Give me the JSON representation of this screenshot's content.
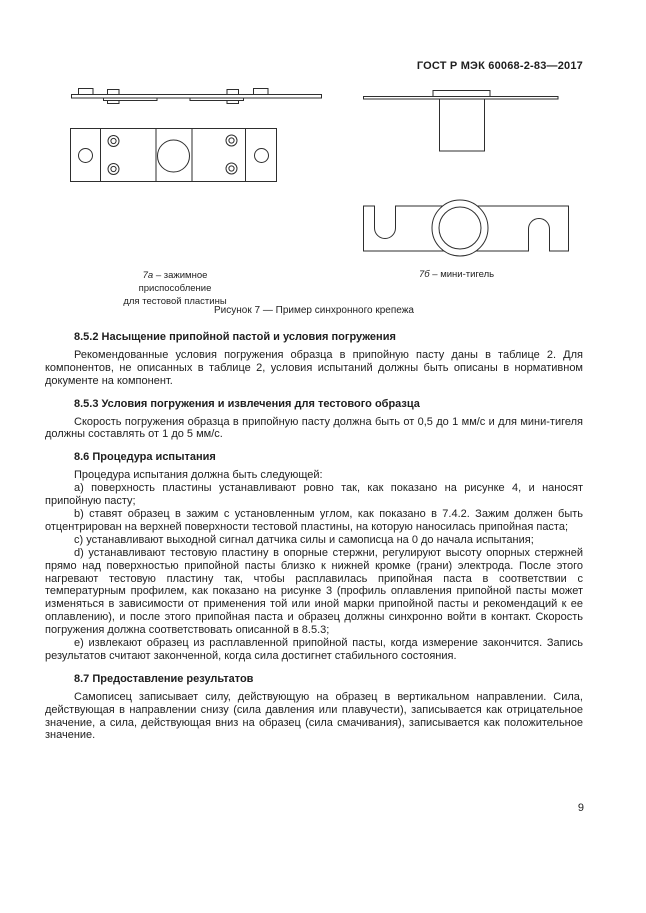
{
  "page": {
    "header_title": "ГОСТ Р МЭК 60068-2-83—2017",
    "page_number": "9"
  },
  "figures": {
    "caption_a": {
      "label": "7а",
      "line1": "– зажимное приспособление",
      "line2": "для тестовой пластины"
    },
    "caption_b": {
      "label": "7б",
      "text": "– мини-тигель"
    },
    "caption_main": "Рисунок 7 — Пример синхронного крепежа"
  },
  "sections": [
    {
      "heading": "8.5.2 Насыщение припойной пастой и условия погружения",
      "paragraphs": [
        "Рекомендованные условия погружения образца в припойную пасту даны в таблице 2. Для компонентов, не описанных в таблице 2, условия испытаний должны быть описаны в нормативном документе на компонент."
      ]
    },
    {
      "heading": "8.5.3 Условия погружения и извлечения для тестового образца",
      "paragraphs": [
        "Скорость погружения образца в припойную пасту должна быть от 0,5 до 1 мм/с и для мини-тигеля должны составлять от 1 до 5 мм/с."
      ]
    },
    {
      "heading": "8.6 Процедура испытания",
      "paragraphs": [
        "Процедура испытания должна быть следующей:",
        "a) поверхность пластины устанавливают ровно так, как показано на рисунке 4, и наносят припойную пасту;",
        "b) ставят образец в зажим с установленным углом, как показано в 7.4.2. Зажим должен быть отцентрирован на верхней поверхности тестовой пластины, на которую наносилась припойная паста;",
        "c) устанавливают выходной сигнал датчика силы и самописца на 0 до начала испытания;",
        "d) устанавливают тестовую пластину в опорные стержни, регулируют высоту опорных стержней прямо над поверхностью припойной пасты близко к нижней кромке (грани) электрода. После этого нагревают тестовую пластину так, чтобы расплавилась припойная паста в соответствии с температурным профилем, как показано на рисунке 3 (профиль оплавления припойной пасты может изменяться в зависимости от применения той или иной марки припойной пасты и рекомендаций к ее оплавлению), и после этого припойная паста и образец должны синхронно войти в контакт. Скорость погружения должна соответствовать описанной в 8.5.3;",
        "e) извлекают образец из расплавленной припойной пасты, когда измерение закончится. Запись результатов считают законченной, когда сила достигнет стабильного состояния."
      ]
    },
    {
      "heading": "8.7 Предоставление результатов",
      "paragraphs": [
        "Самописец записывает силу, действующую на образец в вертикальном направлении. Сила, действующая в направлении снизу (сила давления или плавучести), записывается как отрицательное значение, а сила, действующая вниз на образец (сила смачивания), записывается как положительное значение."
      ]
    }
  ],
  "colors": {
    "background": "#ffffff",
    "text": "#1e1e1e",
    "line_art": "#2e2e2e"
  }
}
